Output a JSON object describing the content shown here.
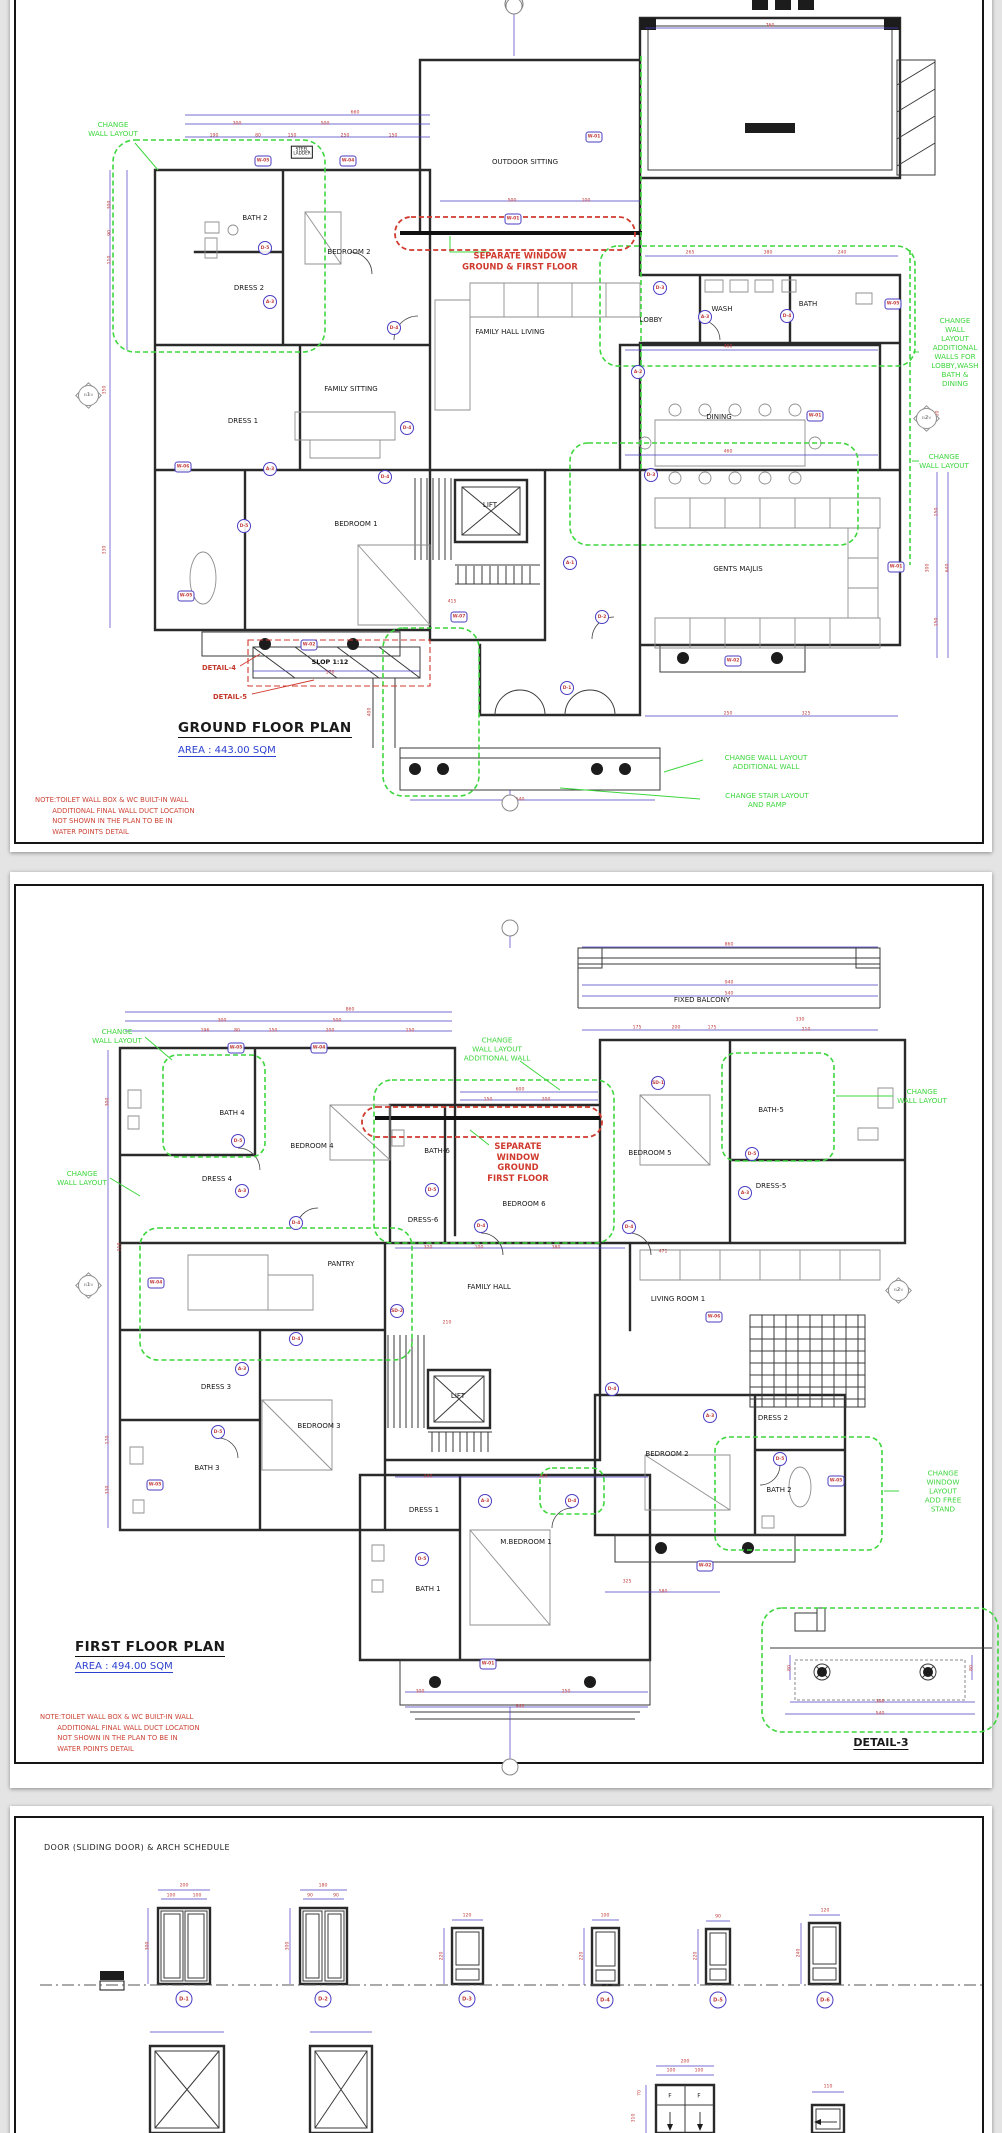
{
  "viewer": {
    "background": "#e4e4e4",
    "page_color": "#ffffff"
  },
  "colors": {
    "revision_green": "#3ed63e",
    "alert_red": "#d03a2e",
    "dimension_blue": "#4a3cc2",
    "dim_text_red": "#c23b3b",
    "area_blue": "#2b3fd0"
  },
  "ground_floor": {
    "title": "GROUND FLOOR  PLAN",
    "area": "AREA : 443.00 SQM",
    "note": "NOTE:TOILET WALL BOX & WC BUILT-IN WALL\n        ADDITIONAL FINAL WALL DUCT LOCATION\n        NOT SHOWN IN THE PLAN TO BE IN\n        WATER POINTS DETAIL",
    "rooms": [
      {
        "t": "BATH 2",
        "x": 255,
        "y": 218
      },
      {
        "t": "BEDROOM 2",
        "x": 349,
        "y": 252
      },
      {
        "t": "DRESS 2",
        "x": 249,
        "y": 288
      },
      {
        "t": "OUTDOOR SITTING",
        "x": 525,
        "y": 162
      },
      {
        "t": "FAMILY HALL LIVING",
        "x": 510,
        "y": 332
      },
      {
        "t": "FAMILY SITTING",
        "x": 351,
        "y": 389
      },
      {
        "t": "DRESS 1",
        "x": 243,
        "y": 421
      },
      {
        "t": "BEDROOM 1",
        "x": 356,
        "y": 524
      },
      {
        "t": "LIFT",
        "x": 490,
        "y": 505
      },
      {
        "t": "LOBBY",
        "x": 651,
        "y": 320
      },
      {
        "t": "WASH",
        "x": 722,
        "y": 309
      },
      {
        "t": "BATH",
        "x": 808,
        "y": 304
      },
      {
        "t": "DINING",
        "x": 719,
        "y": 417
      },
      {
        "t": "GENTS MAJLIS",
        "x": 738,
        "y": 569
      }
    ],
    "annotations": [
      {
        "t": "CHANGE\nWALL LAYOUT",
        "c": "g",
        "x": 113,
        "y": 129
      },
      {
        "t": "CHANGE\nWALL LAYOUT\nADDITIONAL\nWALLS FOR\nLOBBY,WASH\nBATH & DINING",
        "c": "g",
        "x": 955,
        "y": 352
      },
      {
        "t": "CHANGE\nWALL LAYOUT",
        "c": "g",
        "x": 944,
        "y": 461
      },
      {
        "t": "CHANGE WALL LAYOUT\nADDITIONAL WALL",
        "c": "g",
        "x": 766,
        "y": 762
      },
      {
        "t": "CHANGE STAIR LAYOUT\nAND RAMP",
        "c": "g",
        "x": 767,
        "y": 800
      },
      {
        "t": "SEPARATE WINDOW\nGROUND & FIRST FLOOR",
        "c": "r",
        "x": 520,
        "y": 261
      },
      {
        "t": "DETAIL-4",
        "c": "rs",
        "x": 219,
        "y": 668
      },
      {
        "t": "DETAIL-5",
        "c": "rs",
        "x": 230,
        "y": 697
      },
      {
        "t": "SLOP 1:12",
        "c": "ks",
        "x": 330,
        "y": 662
      },
      {
        "t": "STEEL\nLADDER",
        "c": "k",
        "x": 302,
        "y": 152
      }
    ],
    "markers": [
      {
        "id": "W-05",
        "s": "h",
        "x": 263,
        "y": 161
      },
      {
        "id": "W-04",
        "s": "h",
        "x": 348,
        "y": 161
      },
      {
        "id": "W-01",
        "s": "h",
        "x": 594,
        "y": 137
      },
      {
        "id": "W-01",
        "s": "h",
        "x": 513,
        "y": 219
      },
      {
        "id": "W-05",
        "s": "h",
        "x": 893,
        "y": 304
      },
      {
        "id": "W-01",
        "s": "h",
        "x": 815,
        "y": 416
      },
      {
        "id": "W-06",
        "s": "h",
        "x": 183,
        "y": 467
      },
      {
        "id": "W-05",
        "s": "h",
        "x": 186,
        "y": 596
      },
      {
        "id": "W-07",
        "s": "h",
        "x": 459,
        "y": 617
      },
      {
        "id": "W-02",
        "s": "h",
        "x": 309,
        "y": 645
      },
      {
        "id": "W-02",
        "s": "h",
        "x": 733,
        "y": 661
      },
      {
        "id": "W-01",
        "s": "h",
        "x": 896,
        "y": 567
      },
      {
        "id": "D-5",
        "s": "c",
        "x": 265,
        "y": 248
      },
      {
        "id": "A-3",
        "s": "c",
        "x": 270,
        "y": 302
      },
      {
        "id": "D-4",
        "s": "c",
        "x": 394,
        "y": 328
      },
      {
        "id": "D-3",
        "s": "c",
        "x": 660,
        "y": 288
      },
      {
        "id": "A-3",
        "s": "c",
        "x": 705,
        "y": 317
      },
      {
        "id": "D-4",
        "s": "c",
        "x": 787,
        "y": 316
      },
      {
        "id": "A-2",
        "s": "c",
        "x": 638,
        "y": 372
      },
      {
        "id": "D-4",
        "s": "c",
        "x": 407,
        "y": 428
      },
      {
        "id": "A-3",
        "s": "c",
        "x": 270,
        "y": 469
      },
      {
        "id": "D-4",
        "s": "c",
        "x": 385,
        "y": 477
      },
      {
        "id": "D-5",
        "s": "c",
        "x": 244,
        "y": 526
      },
      {
        "id": "A-1",
        "s": "c",
        "x": 570,
        "y": 563
      },
      {
        "id": "D-3",
        "s": "c",
        "x": 651,
        "y": 475
      },
      {
        "id": "D-2",
        "s": "c",
        "x": 602,
        "y": 617
      },
      {
        "id": "D-1",
        "s": "c",
        "x": 567,
        "y": 688
      }
    ],
    "dims": [
      {
        "t": "660",
        "x": 355,
        "y": 113
      },
      {
        "t": "300",
        "x": 237,
        "y": 124
      },
      {
        "t": "500",
        "x": 325,
        "y": 124
      },
      {
        "t": "190",
        "x": 214,
        "y": 136
      },
      {
        "t": "80",
        "x": 258,
        "y": 136
      },
      {
        "t": "150",
        "x": 292,
        "y": 136
      },
      {
        "t": "250",
        "x": 345,
        "y": 136
      },
      {
        "t": "150",
        "x": 393,
        "y": 136
      },
      {
        "t": "500",
        "x": 512,
        "y": 201
      },
      {
        "t": "100",
        "x": 586,
        "y": 201
      },
      {
        "t": "760",
        "x": 770,
        "y": 26
      },
      {
        "t": "265",
        "x": 690,
        "y": 253
      },
      {
        "t": "380",
        "x": 768,
        "y": 253
      },
      {
        "t": "240",
        "x": 842,
        "y": 253
      },
      {
        "t": "460",
        "x": 728,
        "y": 347
      },
      {
        "t": "460",
        "x": 728,
        "y": 452
      },
      {
        "t": "250",
        "x": 728,
        "y": 714
      },
      {
        "t": "325",
        "x": 806,
        "y": 714
      },
      {
        "t": "300",
        "x": 110,
        "y": 205,
        "v": 1
      },
      {
        "t": "90",
        "x": 110,
        "y": 233,
        "v": 1
      },
      {
        "t": "110",
        "x": 110,
        "y": 260,
        "v": 1
      },
      {
        "t": "350",
        "x": 105,
        "y": 390,
        "v": 1
      },
      {
        "t": "330",
        "x": 105,
        "y": 550,
        "v": 1
      },
      {
        "t": "150",
        "x": 937,
        "y": 512,
        "v": 1
      },
      {
        "t": "300",
        "x": 928,
        "y": 568,
        "v": 1
      },
      {
        "t": "640",
        "x": 948,
        "y": 568,
        "v": 1
      },
      {
        "t": "150",
        "x": 937,
        "y": 622,
        "v": 1
      },
      {
        "t": "600",
        "x": 938,
        "y": 415,
        "v": 1
      },
      {
        "t": "570",
        "x": 330,
        "y": 673
      },
      {
        "t": "415",
        "x": 452,
        "y": 602
      },
      {
        "t": "400",
        "x": 370,
        "y": 712,
        "v": 1
      },
      {
        "t": "540",
        "x": 520,
        "y": 800
      }
    ],
    "elevs": [
      {
        "n": "1",
        "x": 88,
        "y": 395
      },
      {
        "n": "2",
        "x": 926,
        "y": 418
      }
    ],
    "nodes": [
      {
        "x": 514,
        "y": 6
      },
      {
        "x": 510,
        "y": 803
      }
    ]
  },
  "first_floor": {
    "title": "FIRST FLOOR  PLAN",
    "area": "AREA : 494.00 SQM",
    "detail_label": "DETAIL-3",
    "note": "NOTE:TOILET WALL BOX & WC BUILT-IN WALL\n        ADDITIONAL FINAL WALL DUCT LOCATION\n        NOT SHOWN IN THE PLAN TO BE IN\n        WATER POINTS DETAIL",
    "rooms": [
      {
        "t": "FIXED BALCONY",
        "x": 702,
        "y": 1000
      },
      {
        "t": "BATH 4",
        "x": 232,
        "y": 1113
      },
      {
        "t": "BEDROOM 4",
        "x": 312,
        "y": 1146
      },
      {
        "t": "DRESS 4",
        "x": 217,
        "y": 1179
      },
      {
        "t": "BATH-6",
        "x": 437,
        "y": 1151
      },
      {
        "t": "DRESS-6",
        "x": 423,
        "y": 1220
      },
      {
        "t": "BEDROOM 6",
        "x": 524,
        "y": 1204
      },
      {
        "t": "BEDROOM 5",
        "x": 650,
        "y": 1153
      },
      {
        "t": "BATH-5",
        "x": 771,
        "y": 1110
      },
      {
        "t": "DRESS-5",
        "x": 771,
        "y": 1186
      },
      {
        "t": "PANTRY",
        "x": 341,
        "y": 1264
      },
      {
        "t": "FAMILY HALL",
        "x": 489,
        "y": 1287
      },
      {
        "t": "LIVING ROOM 1",
        "x": 678,
        "y": 1299
      },
      {
        "t": "DRESS 3",
        "x": 216,
        "y": 1387
      },
      {
        "t": "BEDROOM 3",
        "x": 319,
        "y": 1426
      },
      {
        "t": "BATH 3",
        "x": 207,
        "y": 1468
      },
      {
        "t": "LIFT",
        "x": 458,
        "y": 1396
      },
      {
        "t": "DRESS 1",
        "x": 424,
        "y": 1510
      },
      {
        "t": "M.BEDROOM 1",
        "x": 526,
        "y": 1542
      },
      {
        "t": "BATH 1",
        "x": 428,
        "y": 1589
      },
      {
        "t": "BEDROOM 2",
        "x": 667,
        "y": 1454
      },
      {
        "t": "DRESS 2",
        "x": 773,
        "y": 1418
      },
      {
        "t": "BATH 2",
        "x": 779,
        "y": 1490
      }
    ],
    "annotations": [
      {
        "t": "CHANGE\nWALL LAYOUT",
        "c": "g",
        "x": 117,
        "y": 1036
      },
      {
        "t": "CHANGE\nWALL LAYOUT\nADDITIONAL WALL",
        "c": "g",
        "x": 497,
        "y": 1049
      },
      {
        "t": "CHANGE\nWALL LAYOUT",
        "c": "g",
        "x": 82,
        "y": 1178
      },
      {
        "t": "CHANGE\nWALL LAYOUT",
        "c": "g",
        "x": 922,
        "y": 1096
      },
      {
        "t": "CHANGE\nWINDOW LAYOUT\nADD FREE STAND",
        "c": "g",
        "x": 943,
        "y": 1491
      },
      {
        "t": "SEPARATE\nWINDOW\nGROUND\nFIRST FLOOR",
        "c": "r",
        "x": 518,
        "y": 1162
      }
    ],
    "markers": [
      {
        "id": "W-05",
        "s": "h",
        "x": 236,
        "y": 1048
      },
      {
        "id": "W-04",
        "s": "h",
        "x": 319,
        "y": 1048
      },
      {
        "id": "W-04",
        "s": "h",
        "x": 156,
        "y": 1283
      },
      {
        "id": "W-05",
        "s": "h",
        "x": 155,
        "y": 1485
      },
      {
        "id": "W-06",
        "s": "h",
        "x": 714,
        "y": 1317
      },
      {
        "id": "W-01",
        "s": "h",
        "x": 488,
        "y": 1664
      },
      {
        "id": "W-05",
        "s": "h",
        "x": 836,
        "y": 1481
      },
      {
        "id": "W-02",
        "s": "h",
        "x": 705,
        "y": 1566
      },
      {
        "id": "SD-1",
        "s": "c",
        "x": 658,
        "y": 1083
      },
      {
        "id": "SD-2",
        "s": "c",
        "x": 397,
        "y": 1311
      },
      {
        "id": "D-5",
        "s": "c",
        "x": 238,
        "y": 1141
      },
      {
        "id": "A-3",
        "s": "c",
        "x": 242,
        "y": 1191
      },
      {
        "id": "D-4",
        "s": "c",
        "x": 296,
        "y": 1223
      },
      {
        "id": "D-5",
        "s": "c",
        "x": 432,
        "y": 1190
      },
      {
        "id": "D-4",
        "s": "c",
        "x": 481,
        "y": 1226
      },
      {
        "id": "D-4",
        "s": "c",
        "x": 629,
        "y": 1227
      },
      {
        "id": "D-5",
        "s": "c",
        "x": 752,
        "y": 1154
      },
      {
        "id": "A-3",
        "s": "c",
        "x": 745,
        "y": 1193
      },
      {
        "id": "D-4",
        "s": "c",
        "x": 296,
        "y": 1339
      },
      {
        "id": "A-3",
        "s": "c",
        "x": 242,
        "y": 1369
      },
      {
        "id": "D-5",
        "s": "c",
        "x": 218,
        "y": 1432
      },
      {
        "id": "A-3",
        "s": "c",
        "x": 485,
        "y": 1501
      },
      {
        "id": "D-4",
        "s": "c",
        "x": 572,
        "y": 1501
      },
      {
        "id": "D-5",
        "s": "c",
        "x": 422,
        "y": 1559
      },
      {
        "id": "A-3",
        "s": "c",
        "x": 710,
        "y": 1416
      },
      {
        "id": "D-4",
        "s": "c",
        "x": 612,
        "y": 1389
      },
      {
        "id": "D-5",
        "s": "c",
        "x": 780,
        "y": 1459
      }
    ],
    "dims": [
      {
        "t": "860",
        "x": 350,
        "y": 1010
      },
      {
        "t": "300",
        "x": 222,
        "y": 1021
      },
      {
        "t": "500",
        "x": 337,
        "y": 1021
      },
      {
        "t": "196",
        "x": 205,
        "y": 1031
      },
      {
        "t": "80",
        "x": 237,
        "y": 1031
      },
      {
        "t": "150",
        "x": 273,
        "y": 1031
      },
      {
        "t": "200",
        "x": 330,
        "y": 1031
      },
      {
        "t": "150",
        "x": 410,
        "y": 1031
      },
      {
        "t": "860",
        "x": 729,
        "y": 945
      },
      {
        "t": "940",
        "x": 729,
        "y": 983
      },
      {
        "t": "540",
        "x": 729,
        "y": 994
      },
      {
        "t": "175",
        "x": 637,
        "y": 1028
      },
      {
        "t": "200",
        "x": 676,
        "y": 1028
      },
      {
        "t": "175",
        "x": 712,
        "y": 1028
      },
      {
        "t": "330",
        "x": 800,
        "y": 1020
      },
      {
        "t": "210",
        "x": 806,
        "y": 1030
      },
      {
        "t": "600",
        "x": 520,
        "y": 1090
      },
      {
        "t": "150",
        "x": 488,
        "y": 1100
      },
      {
        "t": "200",
        "x": 546,
        "y": 1100
      },
      {
        "t": "320",
        "x": 428,
        "y": 1248
      },
      {
        "t": "100",
        "x": 479,
        "y": 1248
      },
      {
        "t": "380",
        "x": 556,
        "y": 1248
      },
      {
        "t": "471",
        "x": 663,
        "y": 1252
      },
      {
        "t": "210",
        "x": 447,
        "y": 1323
      },
      {
        "t": "300",
        "x": 108,
        "y": 1102,
        "v": 1
      },
      {
        "t": "110",
        "x": 120,
        "y": 1247,
        "v": 1
      },
      {
        "t": "170",
        "x": 108,
        "y": 1440,
        "v": 1
      },
      {
        "t": "330",
        "x": 108,
        "y": 1490,
        "v": 1
      },
      {
        "t": "240",
        "x": 428,
        "y": 1477
      },
      {
        "t": "360",
        "x": 543,
        "y": 1477
      },
      {
        "t": "325",
        "x": 627,
        "y": 1582
      },
      {
        "t": "580",
        "x": 663,
        "y": 1592
      },
      {
        "t": "300",
        "x": 420,
        "y": 1692
      },
      {
        "t": "250",
        "x": 566,
        "y": 1692
      },
      {
        "t": "940",
        "x": 520,
        "y": 1707
      },
      {
        "t": "300",
        "x": 880,
        "y": 1702
      },
      {
        "t": "540",
        "x": 880,
        "y": 1714
      },
      {
        "t": "80",
        "x": 790,
        "y": 1668,
        "v": 1
      },
      {
        "t": "80",
        "x": 972,
        "y": 1668,
        "v": 1
      }
    ],
    "elevs": [
      {
        "n": "1",
        "x": 88,
        "y": 1285
      },
      {
        "n": "2",
        "x": 898,
        "y": 1290
      }
    ],
    "nodes": [
      {
        "x": 510,
        "y": 928
      },
      {
        "x": 510,
        "y": 1767
      }
    ]
  },
  "schedule": {
    "title": "DOOR (SLIDING DOOR) & ARCH SCHEDULE",
    "bubbles": [
      {
        "id": "D-1",
        "x": 184,
        "y": 1999
      },
      {
        "id": "D-2",
        "x": 323,
        "y": 1999
      },
      {
        "id": "D-3",
        "x": 467,
        "y": 1999
      },
      {
        "id": "D-4",
        "x": 605,
        "y": 2000
      },
      {
        "id": "D-5",
        "x": 718,
        "y": 2000
      },
      {
        "id": "D-6",
        "x": 825,
        "y": 2000
      }
    ],
    "doors": [
      {
        "id": "D-1",
        "kind": "double",
        "width": "200",
        "leaves": [
          "100",
          "100"
        ],
        "height": "300"
      },
      {
        "id": "D-2",
        "kind": "double",
        "width": "180",
        "leaves": [
          "90",
          "90"
        ],
        "height": "300"
      },
      {
        "id": "D-3",
        "kind": "single",
        "width": "120",
        "height": "220"
      },
      {
        "id": "D-4",
        "kind": "single",
        "width": "100",
        "height": "220"
      },
      {
        "id": "D-5",
        "kind": "single",
        "width": "90",
        "height": "220"
      },
      {
        "id": "D-6",
        "kind": "single",
        "width": "120",
        "height": "240"
      }
    ],
    "dims": [
      {
        "t": "200",
        "x": 184,
        "y": 1886
      },
      {
        "t": "100",
        "x": 171,
        "y": 1896
      },
      {
        "t": "100",
        "x": 197,
        "y": 1896
      },
      {
        "t": "300",
        "x": 148,
        "y": 1946,
        "v": 1
      },
      {
        "t": "180",
        "x": 323,
        "y": 1886
      },
      {
        "t": "90",
        "x": 310,
        "y": 1896
      },
      {
        "t": "90",
        "x": 336,
        "y": 1896
      },
      {
        "t": "300",
        "x": 288,
        "y": 1946,
        "v": 1
      },
      {
        "t": "120",
        "x": 467,
        "y": 1916
      },
      {
        "t": "220",
        "x": 442,
        "y": 1956,
        "v": 1
      },
      {
        "t": "100",
        "x": 605,
        "y": 1916
      },
      {
        "t": "220",
        "x": 582,
        "y": 1956,
        "v": 1
      },
      {
        "t": "90",
        "x": 718,
        "y": 1917
      },
      {
        "t": "220",
        "x": 696,
        "y": 1956,
        "v": 1
      },
      {
        "t": "120",
        "x": 825,
        "y": 1911
      },
      {
        "t": "240",
        "x": 799,
        "y": 1953,
        "v": 1
      },
      {
        "t": "200",
        "x": 685,
        "y": 2062
      },
      {
        "t": "100",
        "x": 671,
        "y": 2071
      },
      {
        "t": "100",
        "x": 699,
        "y": 2071
      },
      {
        "t": "70",
        "x": 640,
        "y": 2093,
        "v": 1
      },
      {
        "t": "310",
        "x": 634,
        "y": 2118,
        "v": 1
      },
      {
        "t": "110",
        "x": 828,
        "y": 2087
      }
    ],
    "texts": [
      {
        "t": "F",
        "x": 670,
        "y": 2096
      },
      {
        "t": "F",
        "x": 699,
        "y": 2096
      }
    ]
  }
}
